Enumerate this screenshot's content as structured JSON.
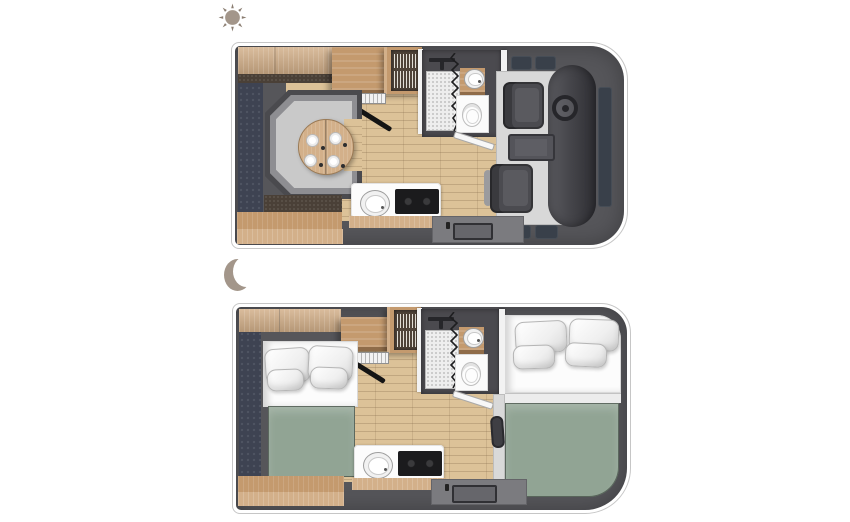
{
  "page": {
    "background_color": "#ffffff",
    "description_visible_text": ""
  },
  "legend": {
    "day": {
      "icon": "sun-icon",
      "meaning": "daytime layout",
      "color": "#a3968a"
    },
    "night": {
      "icon": "moon-icon",
      "meaning": "nighttime layout",
      "color": "#a3968a"
    }
  },
  "colors": {
    "page_bg": "#ffffff",
    "outline": "#c6c6c6",
    "body": "#56565a",
    "navy": "#3e4352",
    "wood": "#d3b08a",
    "wood_mid": "#c49a6e",
    "wood_dark": "#8f6c49",
    "floor": "#dcc298",
    "brown": "#4a4037",
    "cushion": "#c9c9c9",
    "cushion_mid": "#8e8e92",
    "frame": "#4a4a4e",
    "cab_floor": "#d8d8d8",
    "seat": "#4b4b50",
    "dash": "#3c3c41",
    "window": "#39404a",
    "bath_wall": "#4b4a4f",
    "shower": "#eeeeee",
    "white_fix": "#fbfbfb",
    "green": "#91a494",
    "entry": "#7b7b7f",
    "hob": "#1b1b1d",
    "icon": "#a3968a"
  },
  "plans": {
    "day": {
      "id": "day-floorplan",
      "features": [
        "overhead-cabinets",
        "rear-wardrobe",
        "roof-locker",
        "crockery-cabinet-with-dish-rack",
        "draining-rack",
        "kitchen-knife",
        "u-shaped-dinette",
        "round-dining-table",
        "four-place-settings",
        "wood-floor",
        "bathroom",
        "shower",
        "shower-curtain",
        "vanity-washbasin",
        "toilet",
        "bathroom-door",
        "kitchen-counter",
        "kitchen-sink",
        "two-burner-hob",
        "entry-step-mat",
        "cab-floor",
        "driver-seat",
        "steering-wheel",
        "center-seat",
        "passenger-seat",
        "dashboard",
        "cab-windows"
      ]
    },
    "night": {
      "id": "night-floorplan",
      "features": [
        "overhead-cabinets",
        "rear-wardrobe",
        "roof-locker",
        "crockery-cabinet-with-dish-rack",
        "draining-rack",
        "kitchen-knife",
        "rear-bed-mattress",
        "rear-bed-pillows-x4",
        "rear-bed-green-duvet",
        "wood-floor",
        "bathroom",
        "shower",
        "shower-curtain",
        "vanity-washbasin",
        "toilet",
        "bathroom-door",
        "kitchen-counter",
        "kitchen-sink",
        "two-burner-hob",
        "entry-step-mat",
        "overcab-bed-mattress",
        "overcab-bed-pillows-x4",
        "overcab-bed-green-duvet"
      ]
    }
  }
}
